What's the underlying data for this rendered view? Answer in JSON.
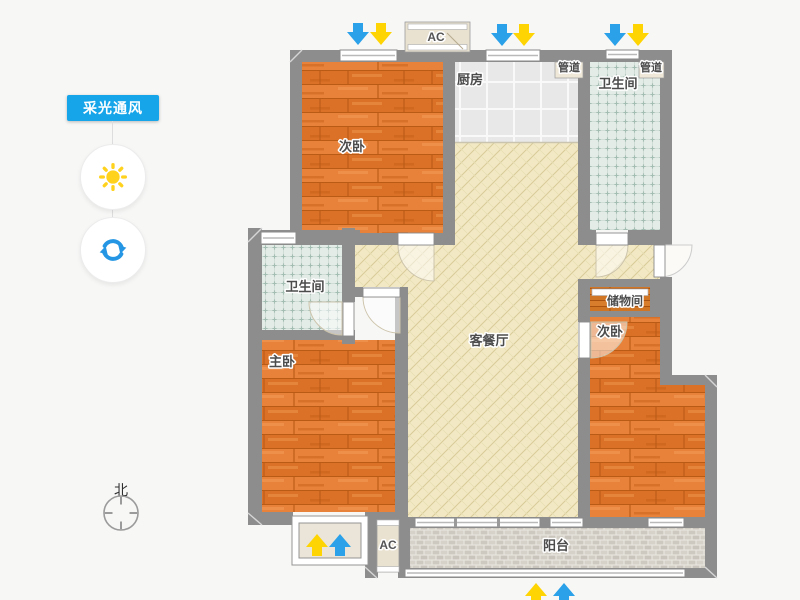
{
  "sidebar": {
    "mode_badge": {
      "label": "采光通风"
    },
    "sun_button": {
      "icon": "sun-icon"
    },
    "refresh_button": {
      "icon": "refresh-icon"
    },
    "compass": {
      "label": "北"
    }
  },
  "floorplan": {
    "rooms": [
      {
        "id": "bedroom-top",
        "label": "次卧"
      },
      {
        "id": "kitchen",
        "label": "厨房"
      },
      {
        "id": "duct-left",
        "label": "管道"
      },
      {
        "id": "duct-right",
        "label": "管道"
      },
      {
        "id": "bathroom-top",
        "label": "卫生间"
      },
      {
        "id": "living-dining",
        "label": "客餐厅"
      },
      {
        "id": "bathroom-left",
        "label": "卫生间"
      },
      {
        "id": "master-bedroom",
        "label": "主卧"
      },
      {
        "id": "storage",
        "label": "储物间"
      },
      {
        "id": "bedroom-right",
        "label": "次卧"
      },
      {
        "id": "balcony",
        "label": "阳台"
      }
    ],
    "ac_units": {
      "top": "AC",
      "bottom": "AC"
    },
    "arrow_colors": {
      "wind": "#2aa1e8",
      "daylight": "#ffd403"
    }
  },
  "colors": {
    "wall": "#8d8d8d",
    "wood_floor": "#e17a2e",
    "living_floor": "#f2e9c4",
    "bath_tile": "#e3ece7",
    "kitchen_tile": "#e8e8e8",
    "balcony_tile": "#cdc9c0",
    "badge_blue": "#17a5e9",
    "sun_yellow": "#ffd21e",
    "refresh_blue": "#2496e3"
  }
}
